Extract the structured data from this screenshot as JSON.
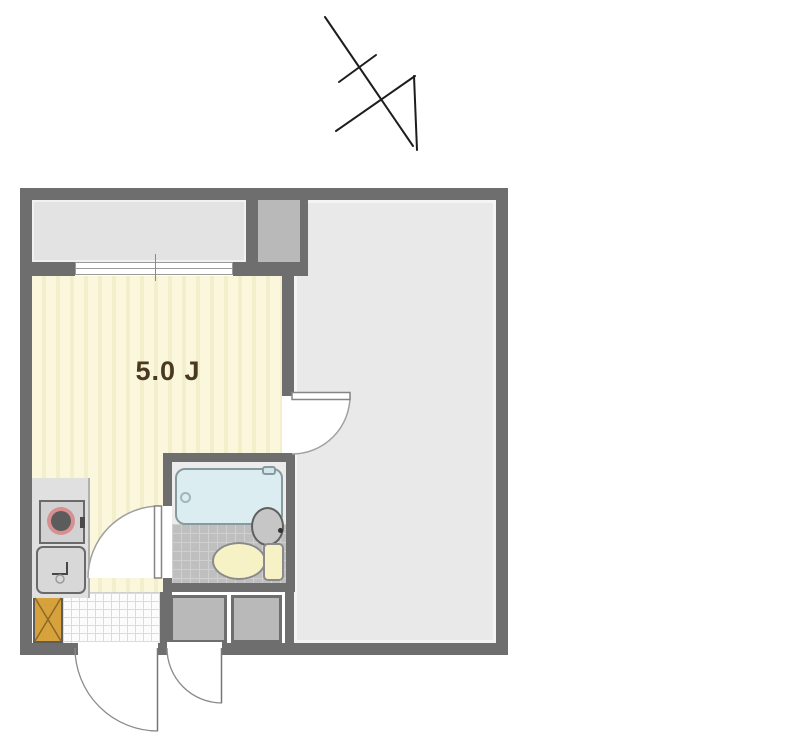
{
  "page": {
    "type": "apartment-floor-plan"
  },
  "room": {
    "label": "5.0 J"
  },
  "compass": {
    "icon": "north-arrow-icon"
  },
  "fixtures": [
    "bathtub",
    "toilet",
    "bath-sink",
    "kitchen-sink",
    "stove",
    "shoe-cabinet",
    "sliding-window",
    "storage-box",
    "storage-box",
    "entrance-door",
    "sub-entrance-door",
    "bathroom-door",
    "room-door"
  ],
  "colors": {
    "wall": "#6e6e6e",
    "balcony": "#e3e3e3",
    "right_room": "#e9e9e9",
    "pipe_shaft": "#b9b9b9",
    "tatami": "#faf7dd",
    "tatami_stripe": "#f3efcd",
    "counter": "#e0e0e0",
    "bath_floor": "#bfbfbf",
    "tub": "#dcedf1",
    "tub_border": "#879a9e",
    "toilet": "#f6f2c6",
    "bath_sink": "#c6c6c6",
    "shoe_cabinet": "#d7a23c",
    "door_stroke": "#a0a0a0",
    "leaf_stroke": "#858585",
    "fixture_border": "#6a6a6a",
    "arrow": "#1d1d1d",
    "label": "#4a3820"
  }
}
